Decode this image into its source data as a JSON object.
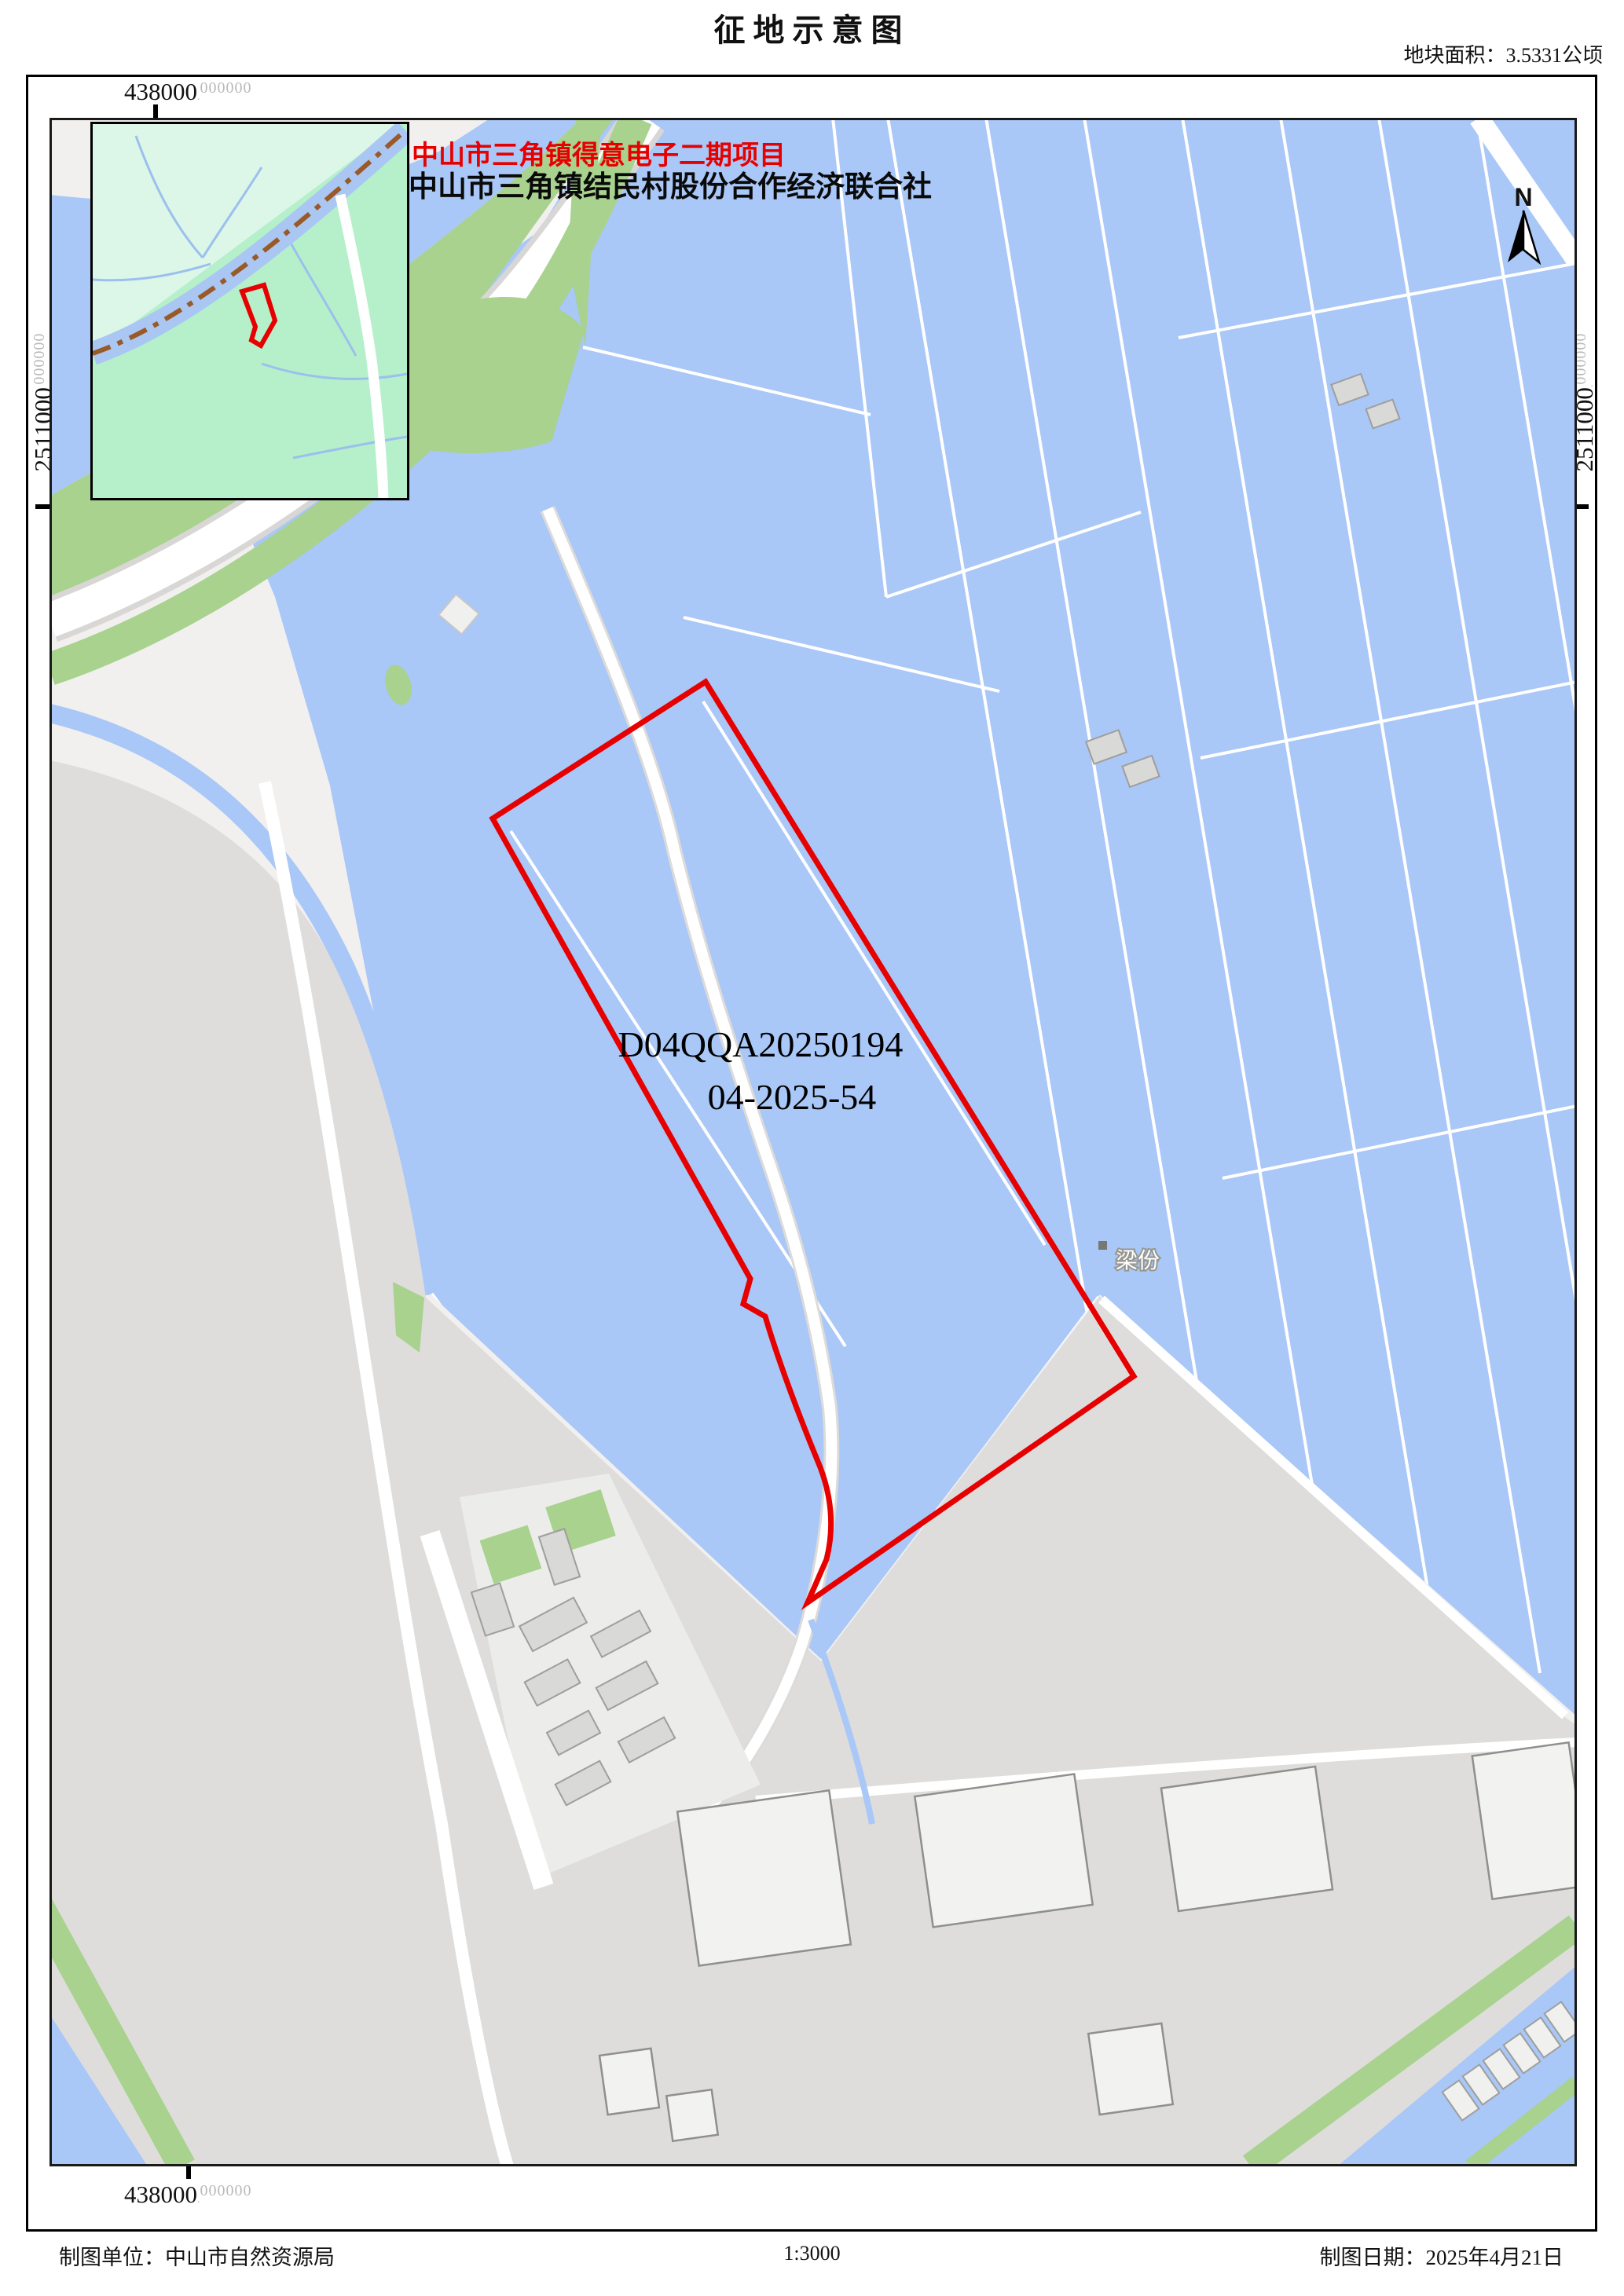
{
  "header": {
    "title": "征地示意图",
    "area_label": "地块面积：3.5331公顷"
  },
  "annotations": {
    "project_name": "中山市三角镇得意电子二期项目",
    "organization": "中山市三角镇结民村股份合作经济联合社",
    "parcel_code": "D04QQA20250194",
    "approval_number": "04-2025-54",
    "place_label": "梁份",
    "north_label": "N"
  },
  "grid": {
    "top_easting": "438000",
    "bottom_easting": "438000",
    "left_northing": "2511000",
    "right_northing": "2511000",
    "decimal_point": ".",
    "decimal_suffix": "000000"
  },
  "footer": {
    "agency": "制图单位：中山市自然资源局",
    "scale": "1:3000",
    "date": "制图日期：2025年4月21日"
  },
  "colors": {
    "parcel_red": "#e60000",
    "pond_blue": "#a9c7f7",
    "vegetation_green": "#a8d28e",
    "urban_gray": "#dedddc",
    "inset_green": "#b5f0ca",
    "inset_mint": "#dcf6e8",
    "boundary_brown": "#9a5a28"
  }
}
